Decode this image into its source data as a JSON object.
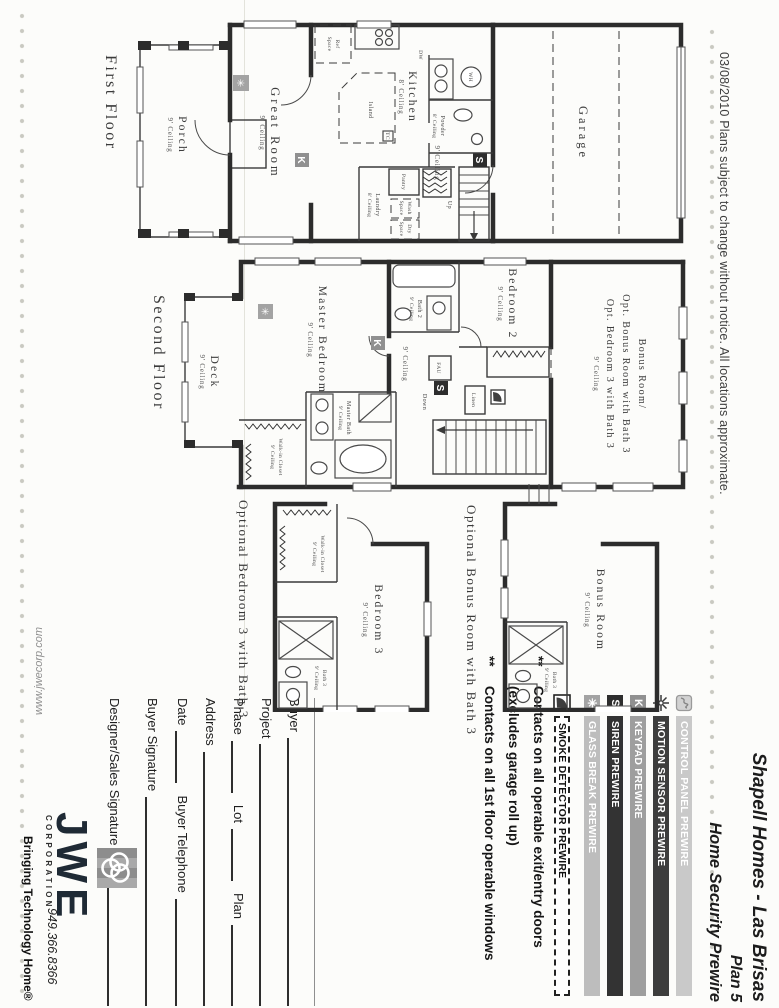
{
  "meta": {
    "date_note": "03/08/2010 Plans subject to change without notice. All locations approximate."
  },
  "title": {
    "project": "Shapell Homes - Las Brisas",
    "plan": "Plan 5",
    "subtitle": "Home Security Prewire"
  },
  "colors": {
    "bar_control_panel": "#c9c9c9",
    "bar_motion_sensor": "#3d3d3d",
    "bar_keypad": "#9e9e9e",
    "bar_siren": "#333333",
    "bar_glass_break": "#bdbdbd",
    "bar_smoke_detector": "#ffffff",
    "logo_navy": "#1f2a35"
  },
  "icons": {
    "keypad": "K",
    "siren": "S",
    "glass_break": "✳"
  },
  "legend": {
    "items": [
      {
        "id": "control-panel",
        "label": "CONTROL PANEL PREWIRE"
      },
      {
        "id": "motion-sensor",
        "label": "MOTION SENSOR PREWIRE"
      },
      {
        "id": "keypad",
        "label": "KEYPAD PREWIRE"
      },
      {
        "id": "siren",
        "label": "SIREN PREWIRE"
      },
      {
        "id": "glass-break",
        "label": "GLASS BREAK PREWIRE"
      },
      {
        "id": "smoke-detector",
        "label": "SMOKE DETECTOR PREWIRE"
      }
    ]
  },
  "notes": {
    "bullet": "**",
    "line1": "Contacts on all operable exit/entry doors",
    "line2": "(excludes garage roll up)",
    "line3": "Contacts on all 1st floor operable windows"
  },
  "form": {
    "buyer": "Buyer",
    "project": "Project",
    "phase": "Phase",
    "lot": "Lot",
    "plan": "Plan",
    "address": "Address",
    "date": "Date",
    "buyer_telephone": "Buyer Telephone",
    "buyer_signature": "Buyer Signature",
    "designer_signature": "Designer/Sales Signature"
  },
  "logo": {
    "name": "JWE",
    "corporation": "CORPORATION",
    "phone": "949.366.8366",
    "tagline": "Bringing Technology Home®",
    "website": "www.jwecorp.com"
  },
  "floors": {
    "first": {
      "label": "First Floor",
      "garage": "Garage",
      "kitchen": "Kitchen",
      "kitchen_ceiling": "8' Ceiling",
      "island": "Island",
      "tc": "TC",
      "ref_space1": "Ref",
      "ref_space2": "Space",
      "dw": "DW",
      "wh": "WH",
      "powder": "Powder",
      "powder_ceiling": "8' Ceiling",
      "hall_ceiling": "9' Ceiling",
      "pantry": "Pantry",
      "wash1": "Wash",
      "wash2": "Space",
      "dry1": "Dry",
      "dry2": "Space",
      "laundry": "Laundry",
      "laundry_ceiling": "8' Ceiling",
      "up": "Up",
      "great_room": "Great Room",
      "great_room_ceiling": "9' Ceiling",
      "porch": "Porch",
      "porch_ceiling": "9' Ceiling"
    },
    "second": {
      "label": "Second Floor",
      "bonus_line1": "Bonus Room/",
      "bonus_line2": "Opt. Bonus Room with Bath 3",
      "bonus_line3": "Opt. Bedroom 3 with Bath 3",
      "bonus_ceiling": "9' Ceiling",
      "bedroom2": "Bedroom 2",
      "bedroom2_ceiling": "9' Ceiling",
      "bath2": "Bath 2",
      "bath2_ceiling": "9' Ceiling",
      "master_bedroom": "Master Bedroom",
      "master_bedroom_ceiling": "9' Ceiling",
      "master_bath": "Master Bath",
      "master_bath_ceiling": "9' Ceiling",
      "walkin_closet": "Walk-in Closet",
      "walkin_ceiling": "9' Ceiling",
      "deck": "Deck",
      "deck_ceiling": "9' Ceiling",
      "hall_ceiling": "9' Ceiling",
      "linen": "Linen",
      "fau": "FAU",
      "down": "Down"
    },
    "opt_bonus": {
      "caption": "Optional Bonus Room with Bath 3",
      "room": "Bonus Room",
      "ceiling": "9' Ceiling",
      "bath3": "Bath 3",
      "bath3_ceiling": "9' Ceiling"
    },
    "opt_bedroom3": {
      "caption": "Optional Bedroom 3 with Bath 3",
      "room": "Bedroom 3",
      "ceiling": "9' Ceiling",
      "closet": "Walk-in Closet",
      "closet_ceiling": "9' Ceiling",
      "bath3": "Bath 3",
      "bath3_ceiling": "9' Ceiling"
    }
  }
}
